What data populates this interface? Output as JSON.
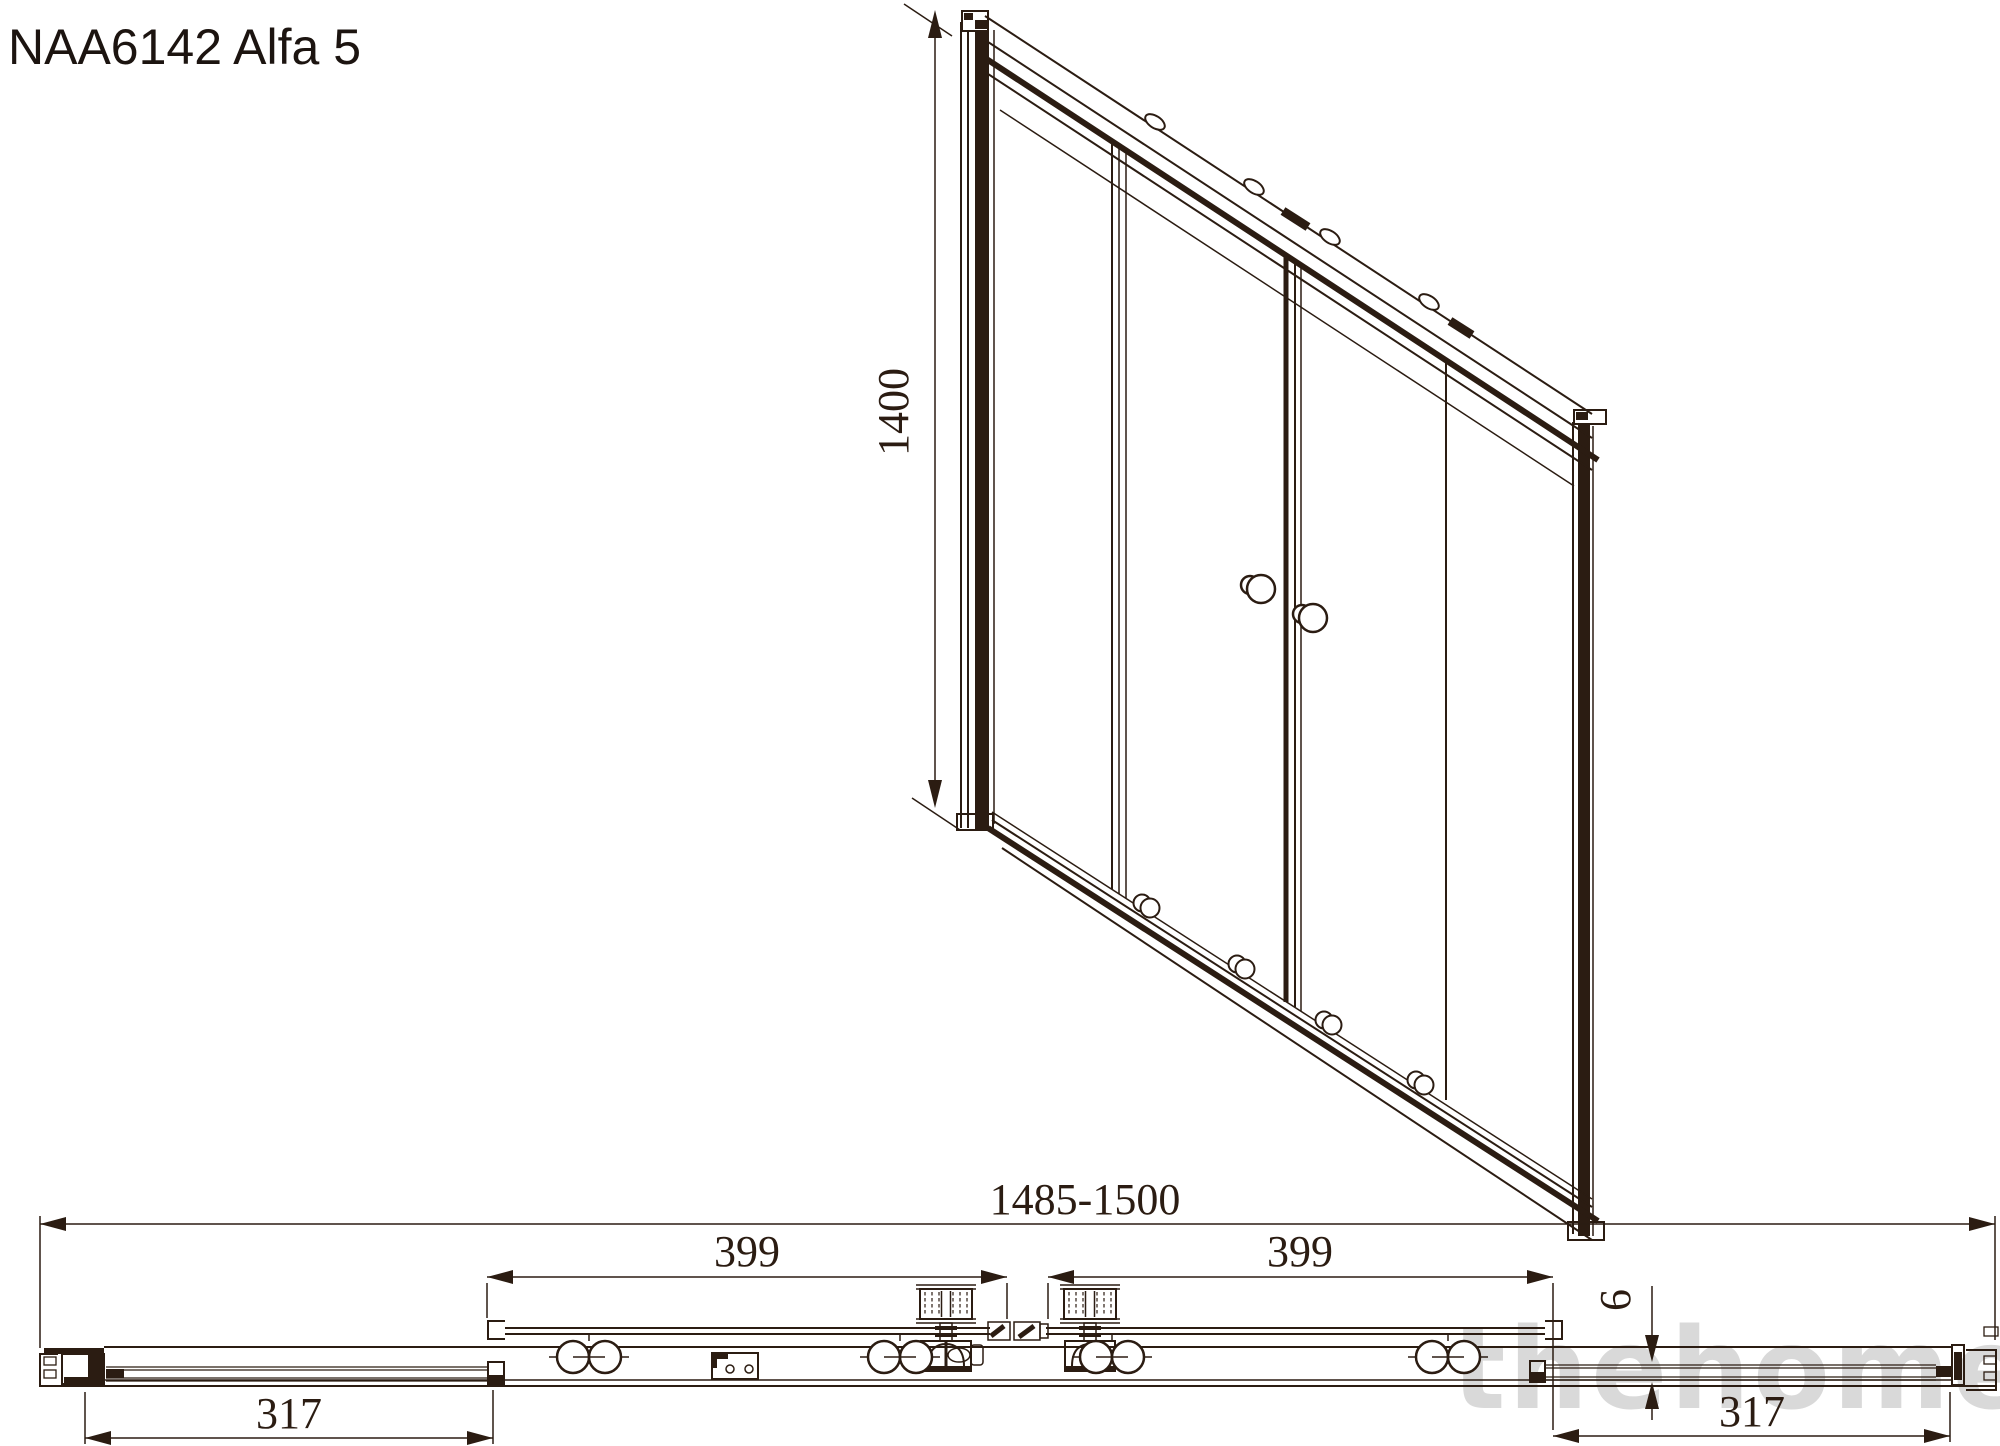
{
  "title": "NAA6142 Alfa 5",
  "watermark": "thehome",
  "colors": {
    "line": "#2b1c12",
    "watermark": "#d9d9d9",
    "bg": "#ffffff",
    "title": "#1c1410"
  },
  "front_view": {
    "description": "perspective view of 4-panel sliding shower screen",
    "height_label": "1400"
  },
  "section_view": {
    "description": "horizontal section through bottom track",
    "total_width_label": "1485-1500",
    "panel_width_left_label": "399",
    "panel_width_right_label": "399",
    "glass_thickness_label": "6",
    "fixed_panel_left_label": "317",
    "fixed_panel_right_label": "317"
  }
}
